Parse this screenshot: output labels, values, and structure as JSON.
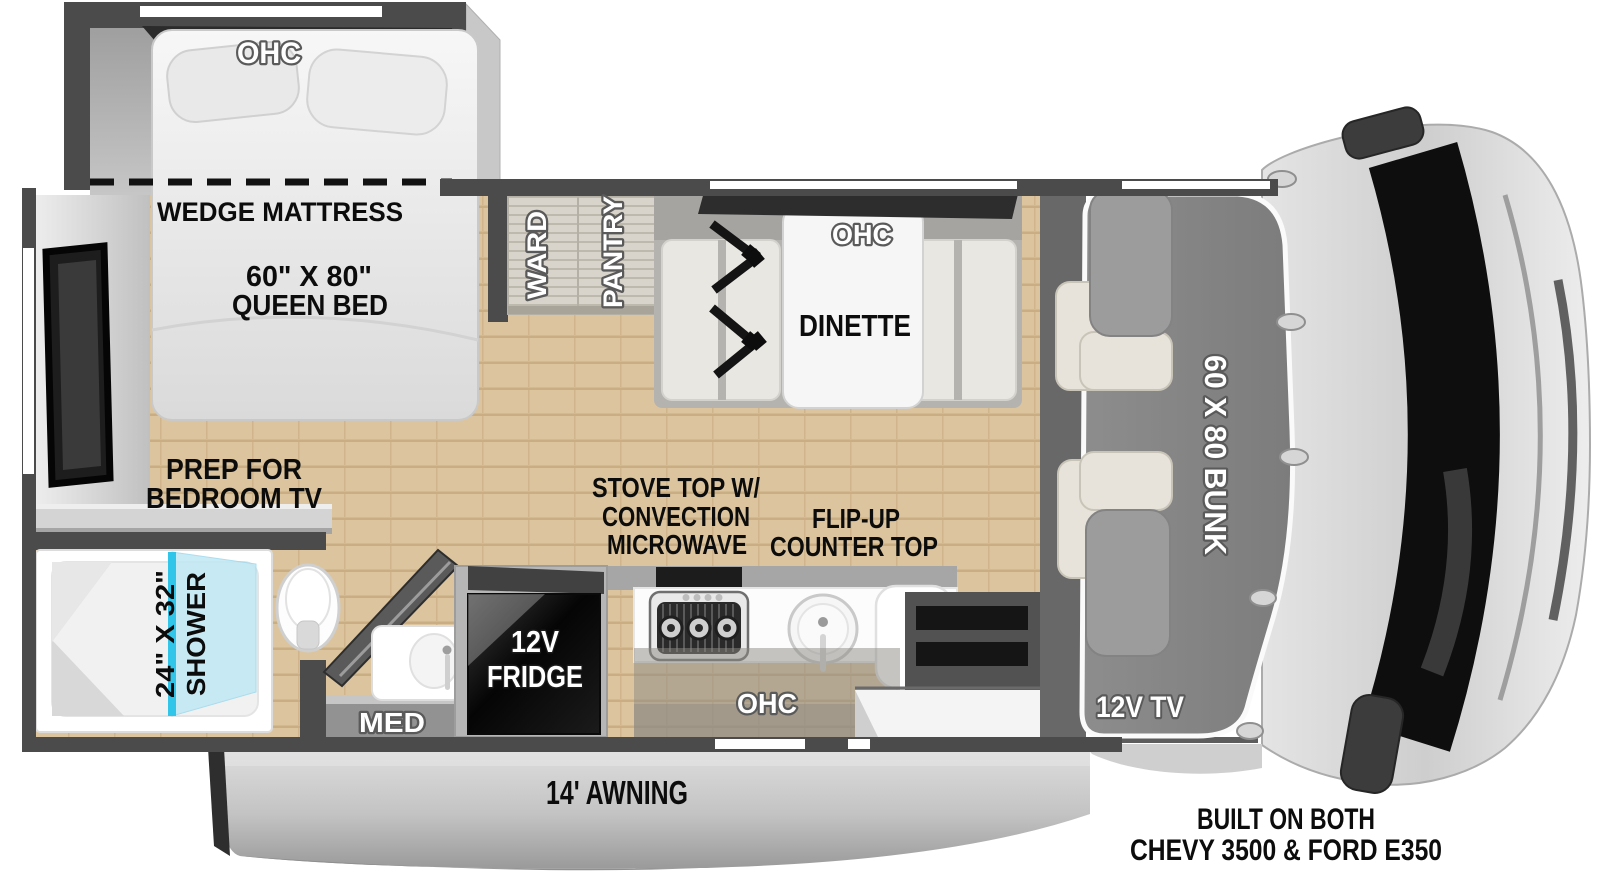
{
  "labels": {
    "bedroom_ohc": "OHC",
    "wedge_mattress": "WEDGE MATTRESS",
    "queen_size": "60\" X 80\"",
    "queen_type": "QUEEN BED",
    "tv_prep_1": "PREP FOR",
    "tv_prep_2": "BEDROOM TV",
    "shower_size": "24\" X 32\"",
    "shower": "SHOWER",
    "med": "MED",
    "fridge_1": "12V",
    "fridge_2": "FRIDGE",
    "ward": "WARD",
    "pantry": "PANTRY",
    "dinette_ohc": "OHC",
    "dinette": "DINETTE",
    "stove_1": "STOVE TOP W/",
    "stove_2": "CONVECTION",
    "stove_3": "MICROWAVE",
    "flip_1": "FLIP-UP",
    "flip_2": "COUNTER TOP",
    "kitchen_ohc": "OHC",
    "bunk": "60 X 80 BUNK",
    "cab_tv": "12V TV",
    "awning": "14' AWNING",
    "built_1": "BUILT ON BOTH",
    "built_2": "CHEVY 3500 & FORD E350"
  },
  "colors": {
    "wall": "#4b4b4b",
    "floor_wood": "#dcc59e",
    "bunk_gray": "#868686",
    "shower_glass": "#31c5e9",
    "cab_body": "#d6d6d6",
    "fridge_face": "#0a0a0a",
    "awning_gray": "#c2c2c2"
  }
}
